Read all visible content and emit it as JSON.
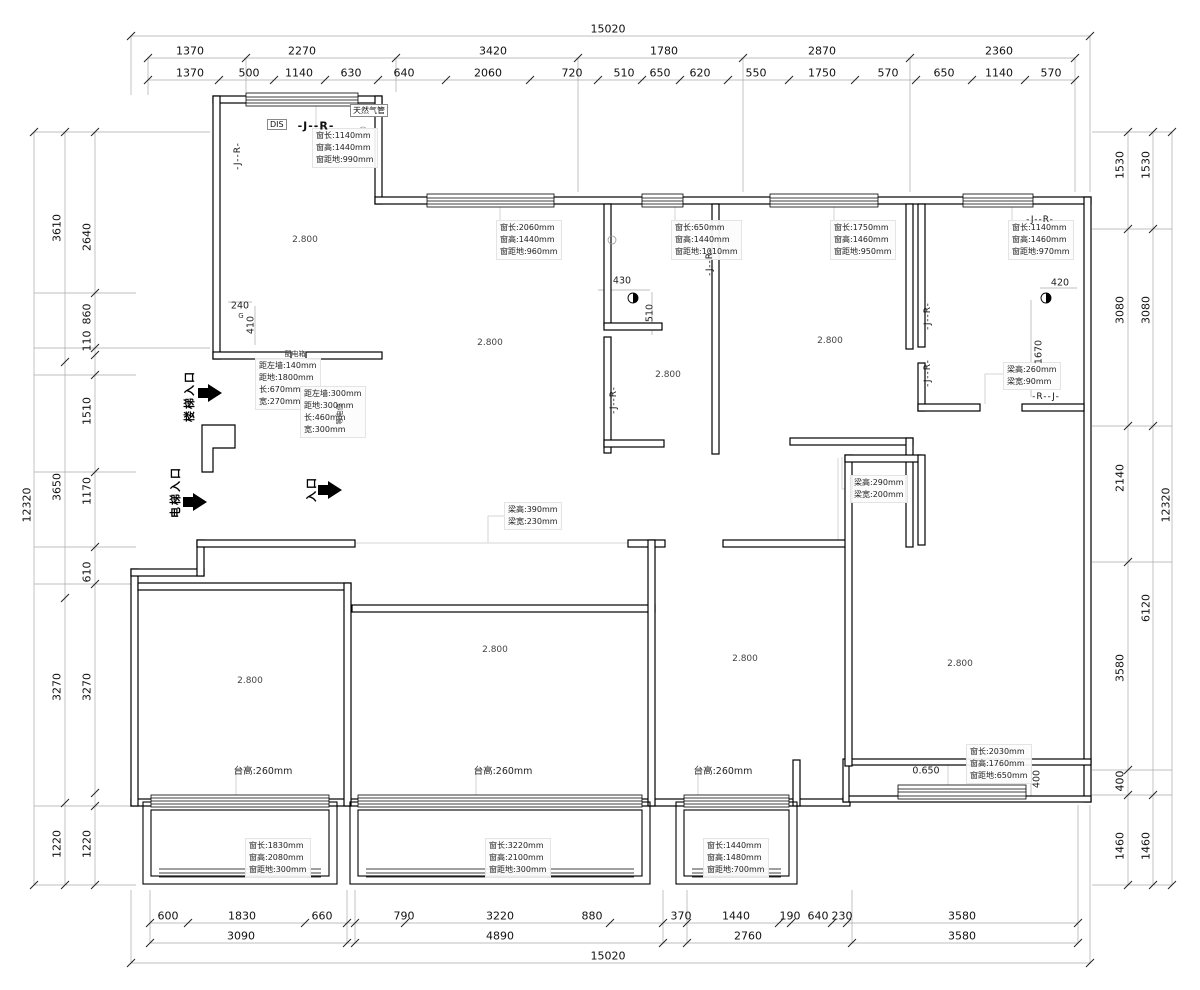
{
  "drawing": {
    "dims_top": {
      "total": "15020",
      "row1": [
        "1370",
        "2270",
        "3420",
        "1780",
        "2870",
        "2360"
      ],
      "row2": [
        "1370",
        "500",
        "1140",
        "630",
        "640",
        "2060",
        "720",
        "510",
        "650",
        "620",
        "550",
        "1750",
        "570",
        "650",
        "1140",
        "570"
      ]
    },
    "dims_bottom": {
      "total": "15020",
      "row1": [
        "600",
        "1830",
        "660",
        "790",
        "3220",
        "880",
        "370",
        "1440",
        "190",
        "640",
        "230",
        "3580"
      ],
      "row2": [
        "3090",
        "4890",
        "2760",
        "3580"
      ]
    },
    "dims_left": {
      "total": "12320",
      "mid": [
        "3610",
        "3650",
        "3270",
        "1220"
      ],
      "inner": [
        "2640",
        "860",
        "110",
        "1510",
        "1170",
        "610",
        "3270",
        "1220"
      ]
    },
    "dims_right": {
      "total": "12320",
      "mid": [
        "1530",
        "3080",
        "6120",
        "1460"
      ],
      "inner": [
        "1530",
        "3080",
        "2140",
        "3580",
        "400",
        "1460"
      ]
    },
    "windows": [
      {
        "lines": [
          "窗长:1140mm",
          "窗高:1440mm",
          "窗距地:990mm"
        ]
      },
      {
        "lines": [
          "窗长:2060mm",
          "窗高:1440mm",
          "窗距地:960mm"
        ]
      },
      {
        "lines": [
          "窗长:650mm",
          "窗高:1440mm",
          "窗距地:1010mm"
        ]
      },
      {
        "lines": [
          "窗长:1750mm",
          "窗高:1460mm",
          "窗距地:950mm"
        ]
      },
      {
        "lines": [
          "窗长:1140mm",
          "窗高:1460mm",
          "窗距地:970mm"
        ]
      },
      {
        "lines": [
          "窗长:2030mm",
          "窗高:1760mm",
          "窗距地:650mm"
        ]
      },
      {
        "lines": [
          "窗长:1830mm",
          "窗高:2080mm",
          "窗距地:300mm"
        ]
      },
      {
        "lines": [
          "窗长:3220mm",
          "窗高:2100mm",
          "窗距地:300mm"
        ]
      },
      {
        "lines": [
          "窗长:1440mm",
          "窗高:1480mm",
          "窗距地:700mm"
        ]
      }
    ],
    "beams": [
      {
        "lines": [
          "梁高:390mm",
          "梁宽:230mm"
        ]
      },
      {
        "lines": [
          "梁高:290mm",
          "梁宽:200mm"
        ]
      },
      {
        "lines": [
          "梁高:260mm",
          "梁宽:90mm"
        ]
      }
    ],
    "platforms": [
      "台高:260mm",
      "台高:260mm",
      "台高:260mm"
    ],
    "heights": [
      "2.800",
      "2.800",
      "2.800",
      "2.800",
      "2.800",
      "2.800",
      "2.800",
      "2.800"
    ],
    "small_dims": {
      "d240": "240",
      "d410": "410",
      "d430": "430",
      "d510": "510",
      "d420": "420",
      "d1670": "1670",
      "d400": "400",
      "level": "0.650",
      "g": "G"
    },
    "labels": {
      "dis": "DIS",
      "jr": "-J--R-",
      "rj": "-R--J-",
      "gas_pipe": "天然气管",
      "stair": "楼梯入口",
      "elevator": "电梯入口",
      "entry": "入口",
      "panel": "配电箱",
      "leb": "等电位"
    },
    "notes": {
      "panel": [
        "距左墙:140mm",
        "距地:1800mm",
        "长:670mm",
        "宽:270mm"
      ],
      "leb": [
        "距左墙:300mm",
        "距地:300mm",
        "长:460mm",
        "宽:300mm"
      ]
    }
  }
}
